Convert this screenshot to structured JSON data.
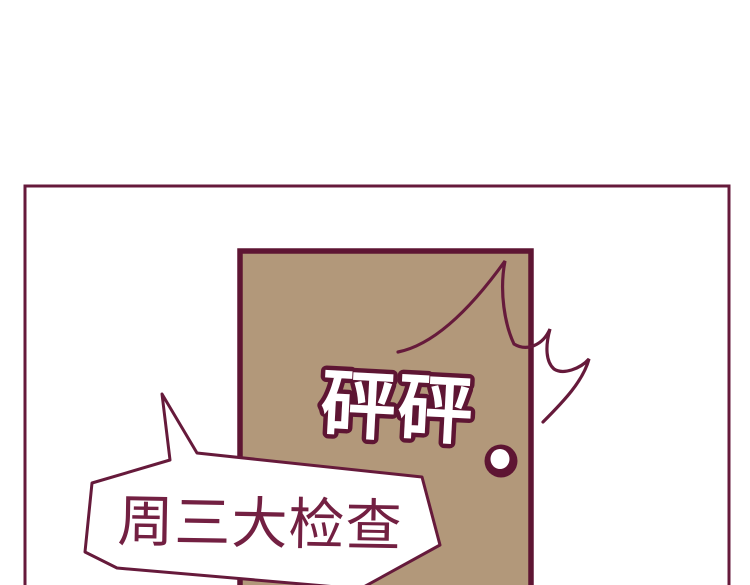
{
  "scene": {
    "background_color": "#ffffff",
    "ink_color": "#661a3b",
    "door": {
      "fill_color": "#b2987a",
      "outline_color": "#5e1533",
      "knock_sfx": "砰砰"
    },
    "doorknob": {
      "ring_color": "#5e1533",
      "center_color": "#ffffff"
    },
    "speech_bubble": {
      "text": "周三大检查",
      "text_color": "#732042",
      "fill_color": "#ffffff",
      "outline_color": "#661a3b"
    }
  }
}
